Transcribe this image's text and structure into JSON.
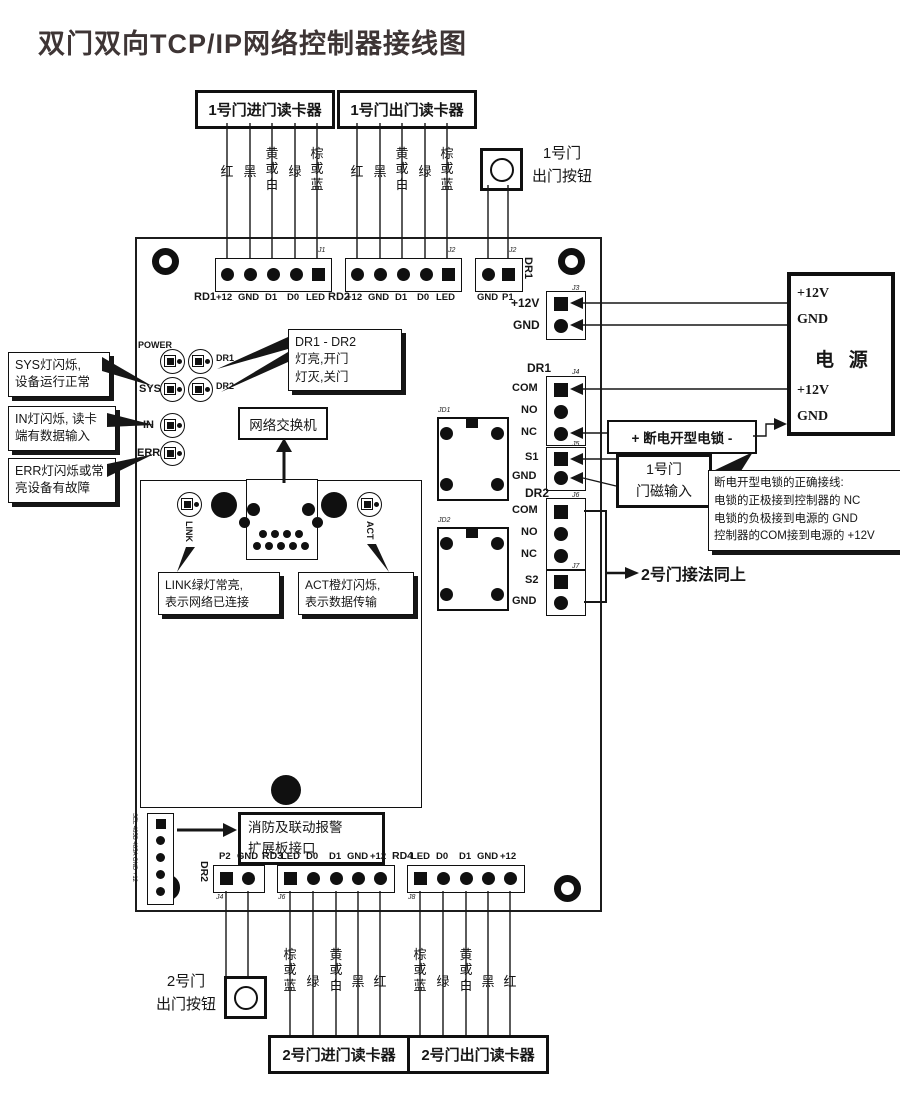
{
  "title": "双门双向TCP/IP网络控制器接线图",
  "wire_colors_top": [
    "红",
    "黑",
    "黄或白",
    "绿",
    "棕或蓝"
  ],
  "wire_colors_bottom": [
    "棕或蓝",
    "绿",
    "黄或白",
    "黑",
    "红"
  ],
  "reader_boxes": {
    "door1_in": "1号门进门读卡器",
    "door1_out": "1号门出门读卡器",
    "door2_in": "2号门进门读卡器",
    "door2_out": "2号门出门读卡器"
  },
  "buttons": {
    "door1_exit": "1号门\n出门按钮",
    "door2_exit": "2号门\n出门按钮"
  },
  "board": {
    "leds": {
      "power": "POWER",
      "sys": "SYS",
      "in": "IN",
      "err": "ERR",
      "dr1": "DR1",
      "dr2": "DR2",
      "link": "LINK",
      "act": "ACT"
    },
    "top_blocks": {
      "rd1": {
        "name": "RD1",
        "jlabel": "J1",
        "pins": [
          "+12",
          "GND",
          "D1",
          "D0",
          "LED"
        ]
      },
      "rd2": {
        "name": "RD2",
        "jlabel": "J2",
        "pins": [
          "+12",
          "GND",
          "D1",
          "D0",
          "LED"
        ]
      },
      "p1": {
        "name": "DR1",
        "jlabel": "J2",
        "pins": [
          "GND",
          "P1"
        ]
      }
    },
    "right_blocks": {
      "power": {
        "jlabel": "J3",
        "pins": [
          "+12V",
          "GND"
        ]
      },
      "dr1": {
        "header": "DR1",
        "jlabel": "J4",
        "pins": [
          "COM",
          "NO",
          "NC"
        ]
      },
      "s1": {
        "jlabel": "J5",
        "pins": [
          "S1",
          "GND"
        ]
      },
      "dr2": {
        "header": "DR2",
        "jlabel": "J6",
        "pins": [
          "COM",
          "NO",
          "NC"
        ]
      },
      "s2": {
        "jlabel": "J7",
        "pins": [
          "S2",
          "GND"
        ]
      }
    },
    "bottom_blocks": {
      "dr2": {
        "name": "DR2",
        "jlabel": "J4",
        "pins": [
          "P2",
          "GND"
        ]
      },
      "rd3": {
        "name": "RD3",
        "jlabel": "J6",
        "pins": [
          "LED",
          "D0",
          "D1",
          "GND",
          "+12"
        ]
      },
      "rd4": {
        "name": "RD4",
        "jlabel": "J8",
        "pins": [
          "LED",
          "D0",
          "D1",
          "GND",
          "+12"
        ]
      }
    },
    "relays": {
      "jd1": "JD1",
      "jd2": "JD2"
    },
    "expansion_pins": "SEL 485B 485A GND +12"
  },
  "callouts": {
    "sys": "SYS灯闪烁,\n设备运行正常",
    "in": "IN灯闪烁, 读卡\n端有数据输入",
    "err": "ERR灯闪烁或常\n亮设备有故障",
    "dr": "DR1 - DR2\n灯亮,开门\n灯灭,关门",
    "link": "LINK绿灯常亮,\n表示网络已连接",
    "act": "ACT橙灯闪烁,\n表示数据传输",
    "lock_note": "断电开型电锁的正确接线:\n电锁的正极接到控制器的 NC\n电锁的负极接到电源的 GND\n控制器的COM接到电源的 +12V"
  },
  "external": {
    "network_switch": "网络交换机",
    "power_supply": {
      "title": "电 源",
      "pins": [
        "+12V",
        "GND",
        "+12V",
        "GND"
      ]
    },
    "lock": "+  断电开型电锁  -",
    "door1_sensor": "1号门\n门磁输入",
    "fire_expansion": "消防及联动报警\n扩展板接口",
    "door2_note": "2号门接法同上"
  }
}
